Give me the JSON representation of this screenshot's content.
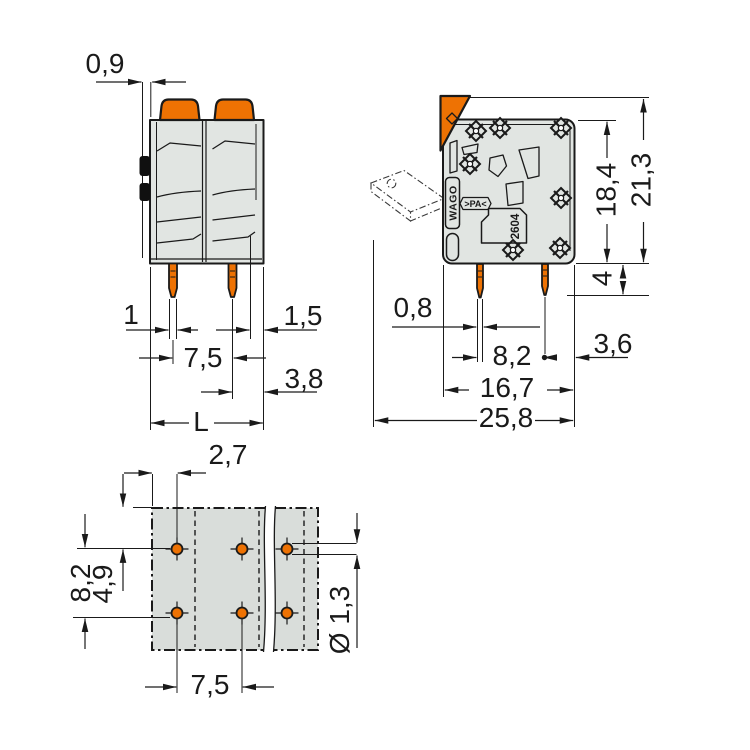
{
  "title": "Terminal block dimensional drawing",
  "colors": {
    "orange": "#EE7203",
    "body_gray": "#E1E5E2",
    "footprint_gray": "#D9DDDA",
    "line": "#1A1A1A"
  },
  "front_view": {
    "dims": {
      "latch_offset": "0,9",
      "pin_width": "1",
      "edge_gap": "1,5",
      "pitch": "7,5",
      "pin_to_edge": "3,8",
      "length": "L"
    }
  },
  "side_view": {
    "dims": {
      "body_height": "18,4",
      "total_height": "21,3",
      "pin_shoulder": "4",
      "pin_thickness": "0,8",
      "row_spacing": "8,2",
      "edge_clearance": "3,6",
      "body_depth": "16,7",
      "total_depth": "25,8"
    },
    "markings": {
      "brand": "WAGO",
      "material": ">PA<",
      "series": "2604"
    }
  },
  "bottom_view": {
    "dims": {
      "edge_to_pin": "2,7",
      "row_spacing": "8,2",
      "edge_to_row": "4,9",
      "pitch": "7,5",
      "hole_diameter": "Ø 1,3"
    }
  }
}
